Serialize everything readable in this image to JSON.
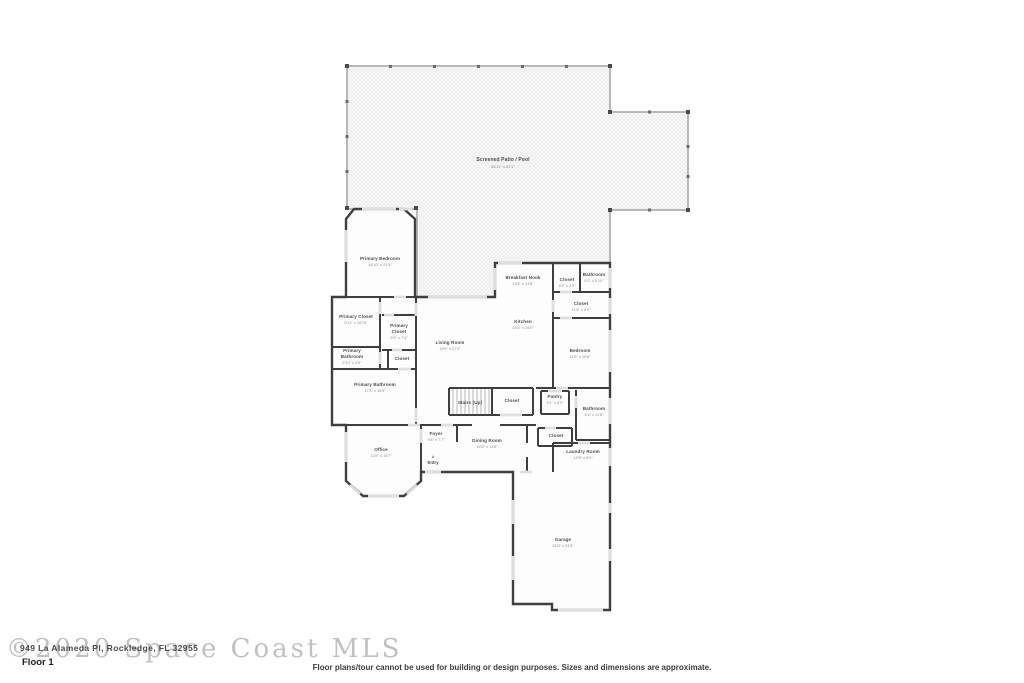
{
  "page": {
    "title": "Floor plan - Floor 1",
    "background_color": "#ffffff",
    "wall_color": "#3f3f3f",
    "patio_wall_color": "#b8b8b8"
  },
  "rooms": [
    {
      "id": "screened-patio",
      "name": "Screened Patio / Pool",
      "dims": "56'11\" x 51'1\""
    },
    {
      "id": "primary-bedroom",
      "name": "Primary Bedroom",
      "dims": "14'10\" x 21'5\""
    },
    {
      "id": "primary-closet-left",
      "name": "Primary Closet",
      "dims": "5'11\" x 10'10\""
    },
    {
      "id": "primary-closet-right",
      "name": "Primary Closet",
      "dims": "6'3\" x 7'4\""
    },
    {
      "id": "primary-bathroom-small",
      "name": "Primary Bathroom",
      "dims": "5'10\" x 4'6\""
    },
    {
      "id": "closet-hall",
      "name": "Closet",
      "dims": ""
    },
    {
      "id": "primary-bathroom",
      "name": "Primary Bathroom",
      "dims": "17'3\" x 16'3\""
    },
    {
      "id": "living-room",
      "name": "Living Room",
      "dims": "19'6\" x 27'3\""
    },
    {
      "id": "breakfast-nook",
      "name": "Breakfast Nook",
      "dims": "13'6\" x 13'8\""
    },
    {
      "id": "kitchen",
      "name": "Kitchen",
      "dims": "14'4\" x 26'0\""
    },
    {
      "id": "bathroom-upper",
      "name": "Bathroom",
      "dims": "6'3\" x 5'10\""
    },
    {
      "id": "closet-upper",
      "name": "Closet",
      "dims": "4'9\" x 2'0\""
    },
    {
      "id": "closet-tall",
      "name": "Closet",
      "dims": "11'6\" x 6'9\""
    },
    {
      "id": "bedroom",
      "name": "Bedroom",
      "dims": "11'5\" x 16'8\""
    },
    {
      "id": "stairs",
      "name": "Stairs (Up)",
      "dims": ""
    },
    {
      "id": "closet-stairs",
      "name": "Closet",
      "dims": ""
    },
    {
      "id": "pantry",
      "name": "Pantry",
      "dims": "4'1\" x 6'3\""
    },
    {
      "id": "bathroom-lower",
      "name": "Bathroom",
      "dims": "5'4\" x 11'8\""
    },
    {
      "id": "closet-mid",
      "name": "Closet",
      "dims": ""
    },
    {
      "id": "laundry-room",
      "name": "Laundry Room",
      "dims": "12'8\" x 8'9\""
    },
    {
      "id": "dining-room",
      "name": "Dining Room",
      "dims": "16'5\" x 13'8\""
    },
    {
      "id": "foyer",
      "name": "Foyer",
      "dims": "9'8\" x 7'7\""
    },
    {
      "id": "office",
      "name": "Office",
      "dims": "13'8\" x 16'7\""
    },
    {
      "id": "garage",
      "name": "Garage",
      "dims": "21'8\" x 31'5\""
    }
  ],
  "entry": {
    "label": "Entry",
    "arrow": "▲"
  },
  "watermark": {
    "mls": "©2020 Space Coast MLS",
    "address": "949 La Alameda Pl, Rockledge, FL 32955"
  },
  "footer": {
    "floor_label": "Floor 1",
    "disclaimer": "Floor plans/tour cannot be used for building or design purposes. Sizes and dimensions are approximate."
  }
}
